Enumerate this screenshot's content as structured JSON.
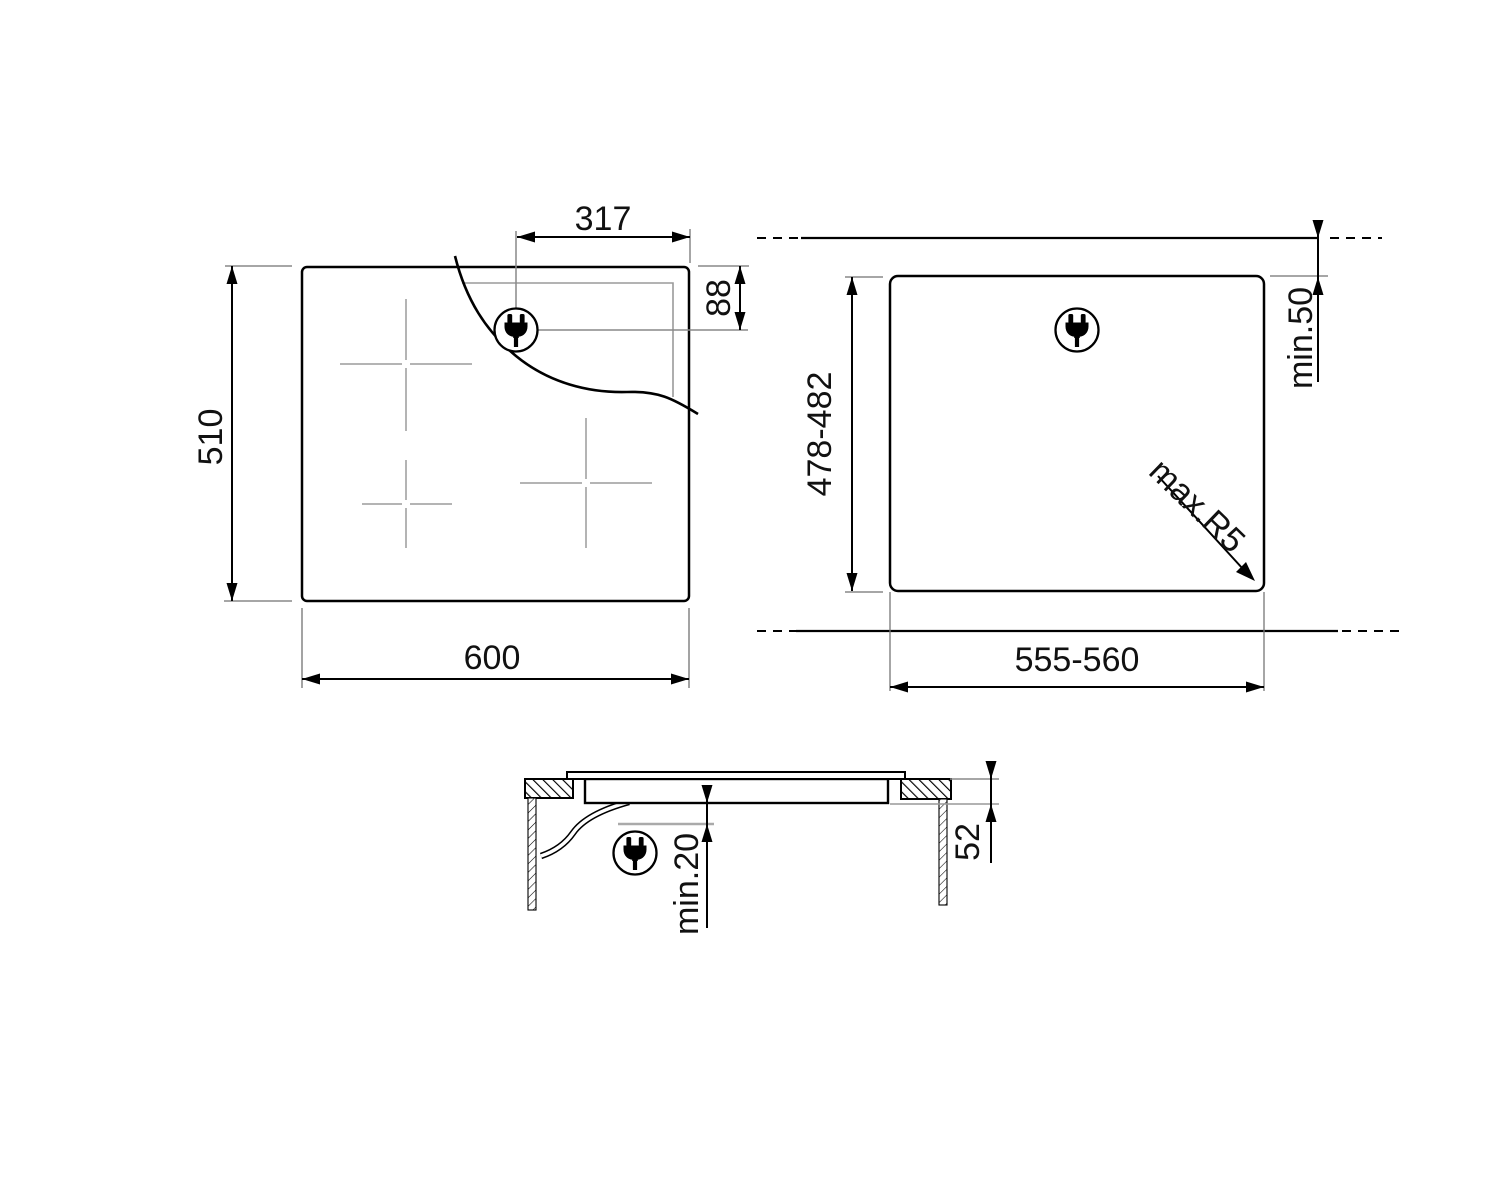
{
  "drawing": {
    "background_color": "#ffffff",
    "line_color": "#000000",
    "gray_line_color": "#999999",
    "plan_view": {
      "width": "600",
      "height": "510",
      "plug_offset_x": "317",
      "plug_offset_y": "88",
      "plug_icon": "power-plug"
    },
    "cutout_view": {
      "width": "555-560",
      "height": "478-482",
      "rear_clearance": "min.50",
      "corner_radius": "max.R5",
      "plug_icon": "power-plug"
    },
    "section_view": {
      "recess_depth": "52",
      "bottom_clearance": "min.20",
      "plug_icon": "power-plug"
    }
  }
}
